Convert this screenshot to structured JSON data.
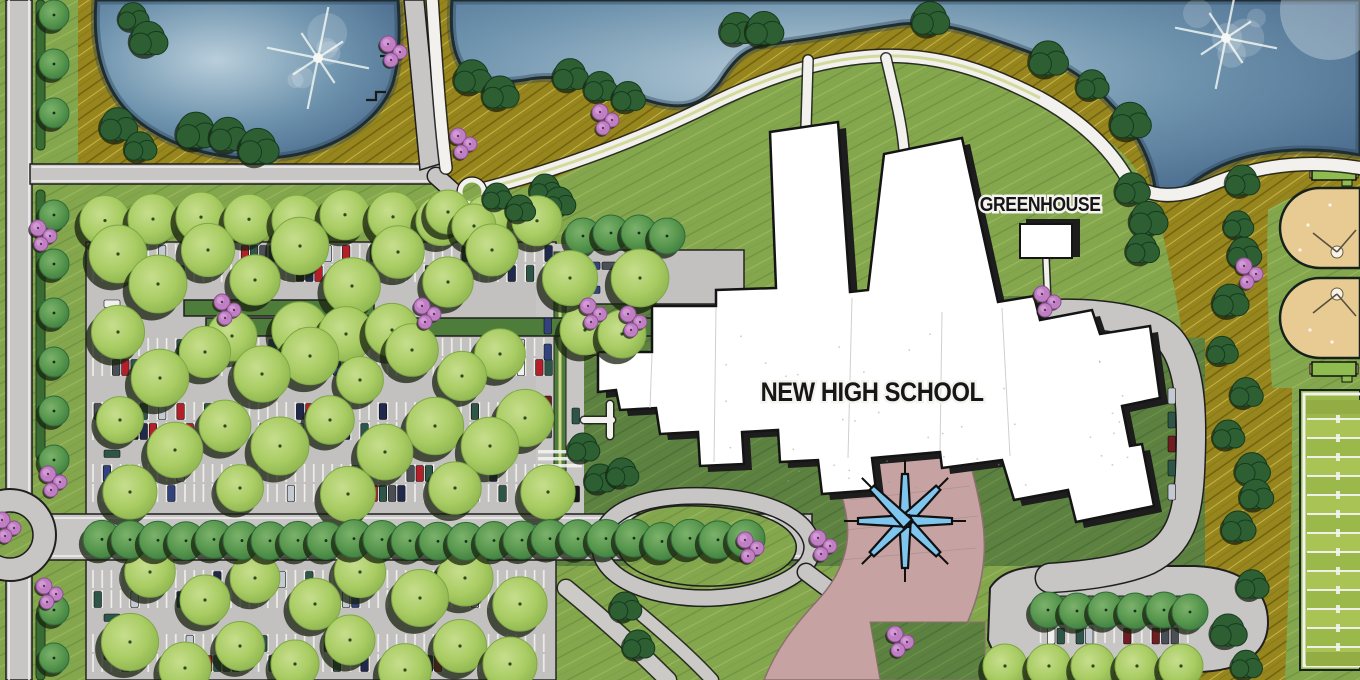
{
  "labels": {
    "school": "NEW HIGH SCHOOL",
    "greenhouse": "GREENHOUSE"
  },
  "palette": {
    "lawn": "#84a74e",
    "lawnHi": "#9cba5f",
    "lawnLo": "#6f9340",
    "lawnDark": "#5d8140",
    "lawnDarkHi": "#6f9448",
    "lawnDarkLo": "#4c6f35",
    "prairie": "#97861e",
    "prairieHi": "#c3b44a",
    "prairieLo": "#6e5f0d",
    "pondDeep": "#47688b",
    "pondMid": "#6e93ad",
    "pondLight": "#b9cedb",
    "shoreline": "#15211c",
    "road": "#c7c6c4",
    "roadEdge": "#f2f1ee",
    "parking": "#c2c1bf",
    "stall": "#f5f4f1",
    "island": "#4e7c3a",
    "hedge": "#3a6b33",
    "treeLight": "#a9cc63",
    "treeLightEdge": "#7fa845",
    "treeMed": "#57964d",
    "treeMedEdge": "#2f6b3a",
    "treeDark": "#2e5f33",
    "treeShadow": "#18220f",
    "pink": "#c07fc2",
    "pinkHi": "#d29ad4",
    "building": "#ffffff",
    "buildingShadow": "#1d1d1d",
    "plaza": "#c6a3a2",
    "plazaEdge": "#8c6f6e",
    "star": "#7fc5ee",
    "tan": "#e8cb93",
    "fieldA": "#a9c455",
    "fieldB": "#9bb84a",
    "white": "#f2f2ef",
    "ink": "#161616",
    "pathTint": "#c9d687"
  },
  "cars": {
    "colors": [
      "#f0f0ee",
      "#17171a",
      "#4a4e55",
      "#c3cad1",
      "#b3202a",
      "#32427f",
      "#20294c",
      "#701d22",
      "#2d5548"
    ]
  },
  "features": [
    "west-pond",
    "east-pond",
    "pond-fountain",
    "prairie-grass",
    "great-lawn",
    "walking-trail",
    "parking-lot",
    "tree-lined-boulevard",
    "roundabout",
    "new-high-school-building",
    "greenhouse-building",
    "entry-plaza",
    "entry-canopy-star",
    "bus-drop-off-loop",
    "baseball-fields",
    "football-field"
  ]
}
